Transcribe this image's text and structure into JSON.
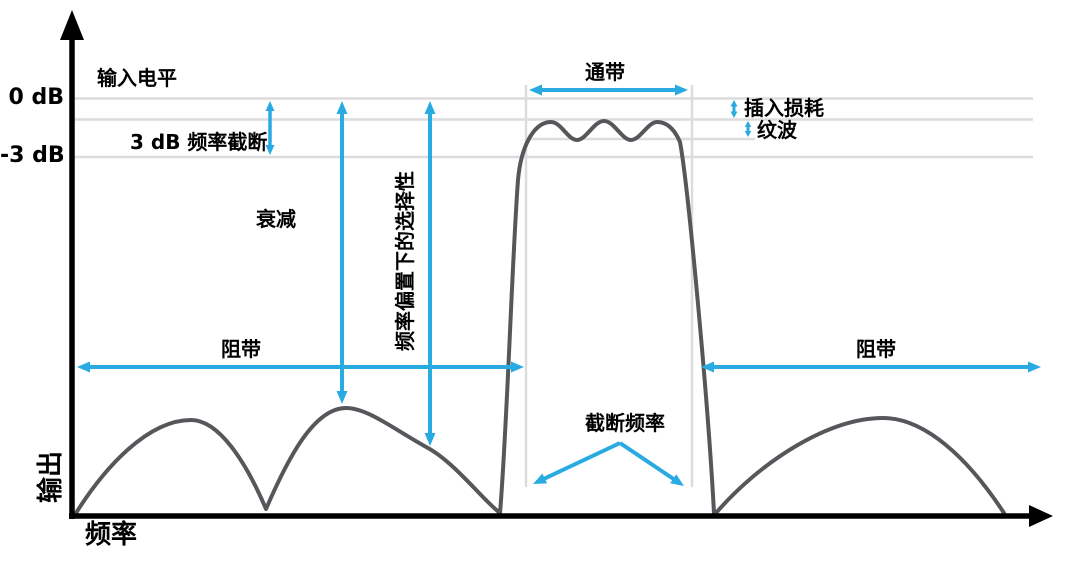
{
  "colors": {
    "accent_blue": "#29ABE2",
    "curve_gray": "#55575B",
    "grid_gray": "#DBDCDE",
    "axis_black": "#000000",
    "background": "#FFFFFF"
  },
  "labels": {
    "zero_db": "0 dB",
    "minus3_db": "-3 dB",
    "input_level": "输入电平",
    "cutoff_3db": "3 dB 频率截断",
    "passband": "通带",
    "insertion_loss": "插入损耗",
    "ripple": "纹波",
    "attenuation": "衰减",
    "selectivity": "频率偏置下的选择性",
    "stopband": "阻带",
    "cutoff_frequency": "截断频率",
    "y_axis": "输出",
    "x_axis": "频率"
  },
  "chart_data": {
    "type": "line",
    "title": "",
    "xlabel": "频率",
    "ylabel": "输出",
    "y_tick_labels": [
      "0 dB",
      "-3 dB"
    ],
    "annotations": [
      "输入电平",
      "3 dB 频率截断",
      "通带",
      "插入损耗",
      "纹波",
      "衰减",
      "频率偏置下的选择性",
      "阻带",
      "阻带",
      "截断频率"
    ]
  },
  "diagram": {
    "canvas": {
      "width": 1080,
      "height": 569
    },
    "axes": {
      "y_line": {
        "x1": 72,
        "y1": 519,
        "x2": 72,
        "y2": 32,
        "width": 5.5
      },
      "y_head": "72,10 60,40 84,40",
      "x_line": {
        "x1": 69,
        "y1": 516,
        "x2": 1032,
        "y2": 516,
        "width": 5.5
      },
      "x_head": "1053,516 1029,505 1029,527"
    },
    "gridlines": [
      {
        "name": "zero-db-gridline",
        "x1": 75,
        "y1": 98.5,
        "x2": 1033,
        "y2": 98.5
      },
      {
        "name": "insertion-loss-gridline",
        "x1": 75,
        "y1": 119.5,
        "x2": 1033,
        "y2": 119.5
      },
      {
        "name": "ripple-floor-gridline",
        "x1": 526,
        "y1": 139,
        "x2": 755,
        "y2": 139
      },
      {
        "name": "minus3-db-gridline",
        "x1": 75,
        "y1": 157,
        "x2": 1033,
        "y2": 157
      },
      {
        "name": "passband-left-edge-line",
        "x1": 526,
        "y1": 85,
        "x2": 526,
        "y2": 487
      },
      {
        "name": "passband-right-edge-line",
        "x1": 692,
        "y1": 85,
        "x2": 692,
        "y2": 487
      }
    ],
    "curve_path": "M 76,513 C 105,467 148,420 191,420 C 219,420 246,462 266,509 C 288,458 314,408 346,408 C 368,408 395,430 428,448 C 455,463 483,500 500,513 C 507,430 512,260 518,180 C 521,146 534,122 551,122 C 561,122 568,140 577,140 C 586,140 594,121 604,121 C 614,121 622,140 631,140 C 640,140 648,122 657,122 C 666,122 674,128 680,142 C 688,185 708,400 714,513 M 716,513 C 760,462 828,418 883,418 C 925,418 968,458 1004,513",
    "arrows": [
      {
        "name": "cutoff-3db-arrow",
        "x1": 270,
        "y1": 101,
        "x2": 270,
        "y2": 155,
        "heads": "both",
        "sw": 3.5,
        "head": [
          10,
          9
        ]
      },
      {
        "name": "attenuation-arrow",
        "x1": 342,
        "y1": 101,
        "x2": 342,
        "y2": 404,
        "heads": "both",
        "sw": 4,
        "head": [
          13,
          11
        ]
      },
      {
        "name": "selectivity-arrow",
        "x1": 430,
        "y1": 101,
        "x2": 430,
        "y2": 446,
        "heads": "both",
        "sw": 4,
        "head": [
          13,
          11
        ]
      },
      {
        "name": "passband-arrow",
        "x1": 529,
        "y1": 90,
        "x2": 688,
        "y2": 90,
        "heads": "both",
        "sw": 4,
        "head": [
          13,
          11
        ]
      },
      {
        "name": "insertion-loss-arrow",
        "x1": 734,
        "y1": 100,
        "x2": 734,
        "y2": 118,
        "heads": "both",
        "sw": 3,
        "head": [
          6.5,
          7
        ]
      },
      {
        "name": "ripple-arrow",
        "x1": 748,
        "y1": 121,
        "x2": 748,
        "y2": 137,
        "heads": "both",
        "sw": 3,
        "head": [
          6,
          6.5
        ]
      },
      {
        "name": "stopband-left-arrow",
        "x1": 77,
        "y1": 367,
        "x2": 524,
        "y2": 367,
        "heads": "both",
        "sw": 4,
        "head": [
          13,
          11
        ]
      },
      {
        "name": "stopband-right-arrow",
        "x1": 701,
        "y1": 367,
        "x2": 1041,
        "y2": 367,
        "heads": "both",
        "sw": 4,
        "head": [
          13,
          11
        ]
      },
      {
        "name": "cutoff-freq-left-pointer",
        "x1": 620,
        "y1": 443,
        "x2": 533,
        "y2": 484,
        "heads": "end",
        "sw": 4,
        "head": [
          13,
          11
        ]
      },
      {
        "name": "cutoff-freq-right-pointer",
        "x1": 620,
        "y1": 443,
        "x2": 684,
        "y2": 486,
        "heads": "end",
        "sw": 4,
        "head": [
          13,
          11
        ]
      }
    ]
  }
}
